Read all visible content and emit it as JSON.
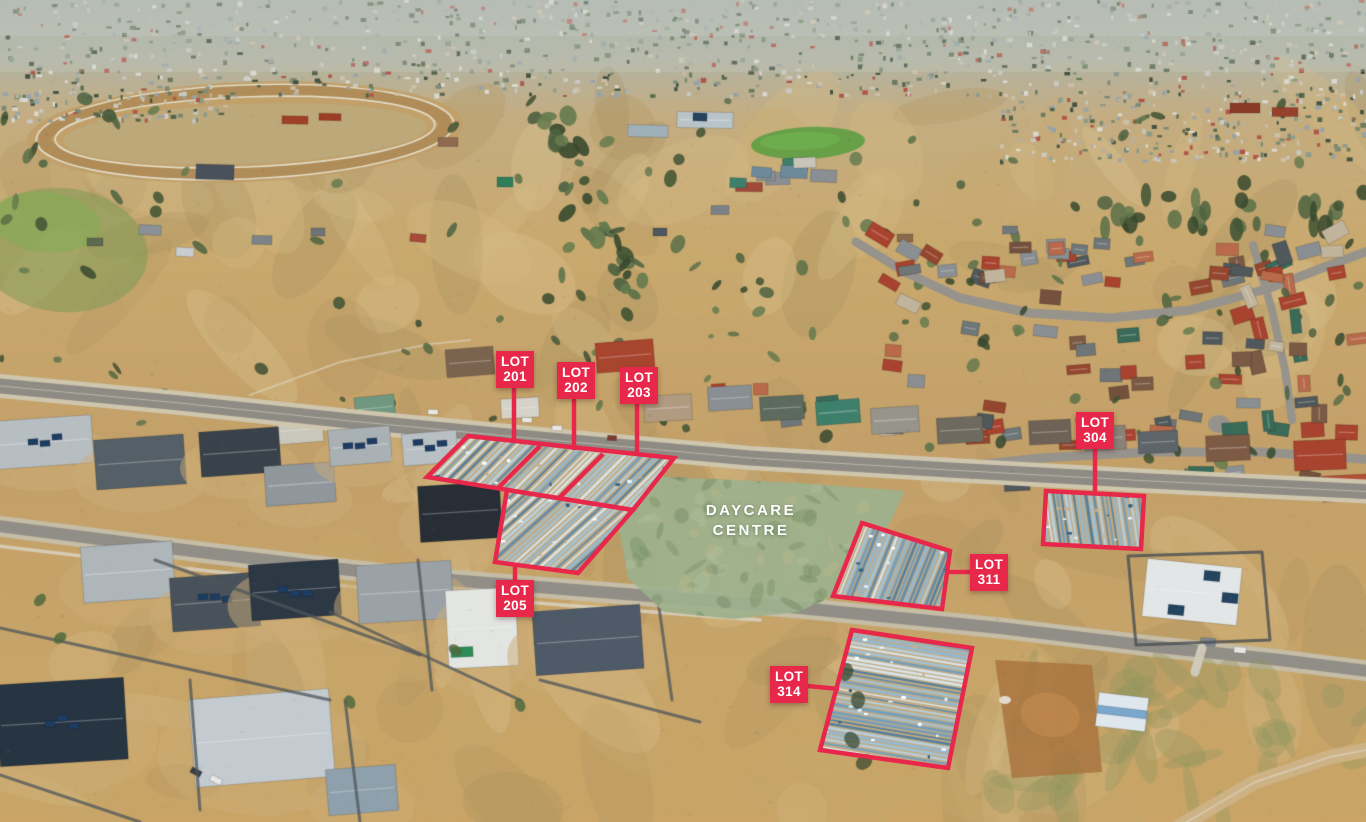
{
  "colors": {
    "label-red": "#e8284a",
    "label-text": "#ffffff",
    "daycare-tint": "#9cb18d"
  },
  "annotations": {
    "lots": [
      {
        "prefix": "LOT",
        "number": "201"
      },
      {
        "prefix": "LOT",
        "number": "202"
      },
      {
        "prefix": "LOT",
        "number": "203"
      },
      {
        "prefix": "LOT",
        "number": "205"
      },
      {
        "prefix": "LOT",
        "number": "304"
      },
      {
        "prefix": "LOT",
        "number": "311"
      },
      {
        "prefix": "LOT",
        "number": "314"
      }
    ],
    "daycare_centre": {
      "line1": "DAYCARE",
      "line2": "CENTRE"
    }
  }
}
